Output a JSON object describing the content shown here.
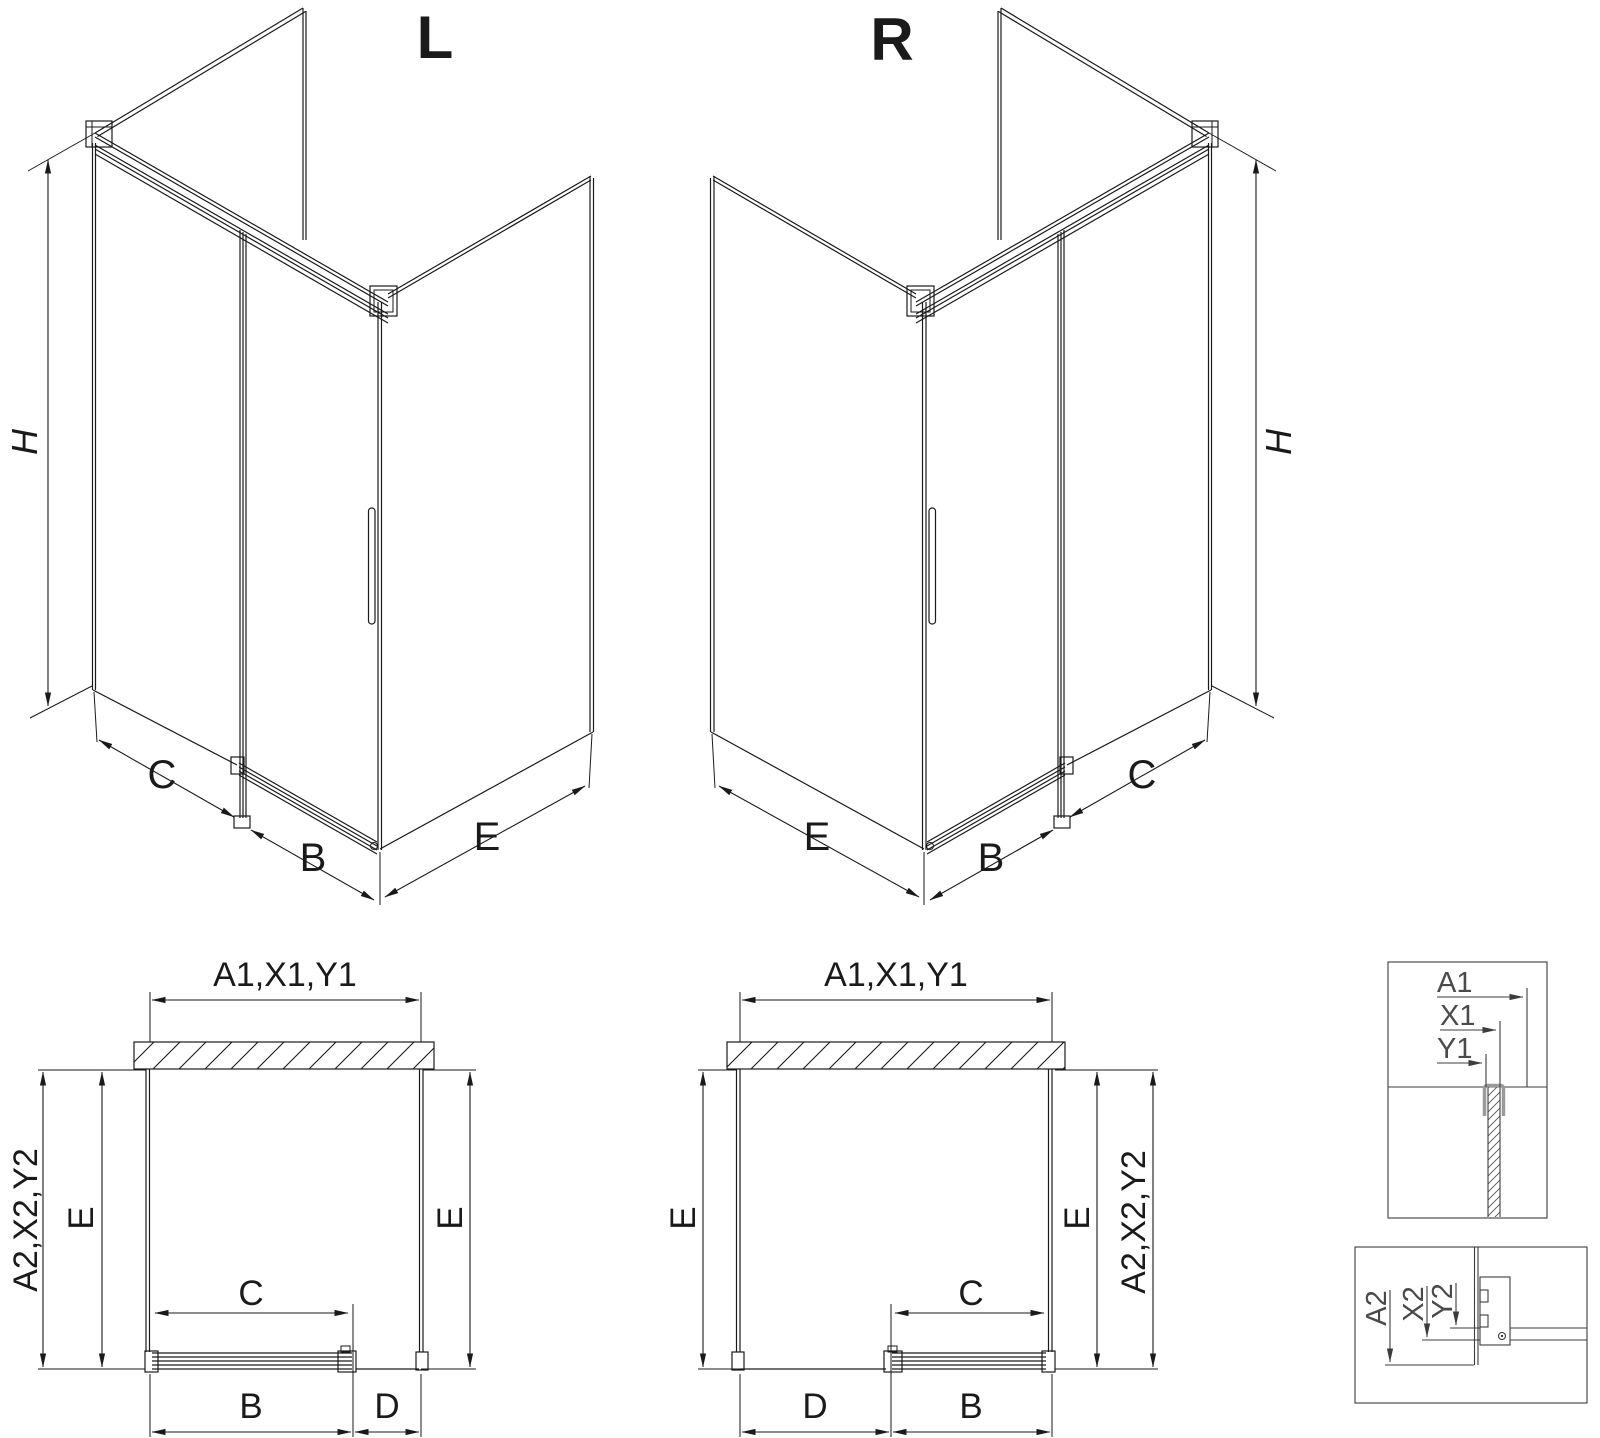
{
  "drawing": {
    "variant_left": {
      "label": "L",
      "height_dim": "H",
      "fixed_width_dim": "C",
      "door_width_dim": "B",
      "side_width_dim": "E"
    },
    "variant_right": {
      "label": "R",
      "height_dim": "H",
      "fixed_width_dim": "C",
      "door_width_dim": "B",
      "side_width_dim": "E"
    },
    "plan_left": {
      "width_dim": "A1,X1,Y1",
      "depth_dim": "A2,X2,Y2",
      "side_left_dim": "E",
      "side_right_dim": "E",
      "opening_dim": "C",
      "door_dim": "B",
      "fixed_dim": "D"
    },
    "plan_right": {
      "width_dim": "A1,X1,Y1",
      "depth_dim": "A2,X2,Y2",
      "side_left_dim": "E",
      "side_right_dim": "E",
      "opening_dim": "C",
      "door_dim": "B",
      "fixed_dim": "D"
    },
    "detail_top": {
      "dim_a": "A1",
      "dim_x": "X1",
      "dim_y": "Y1"
    },
    "detail_bottom": {
      "dim_a": "A2",
      "dim_x": "X2",
      "dim_y": "Y2"
    },
    "colors": {
      "line": "#1a1a1a",
      "detail_line": "#3c3c3c",
      "profile_gray": "#9a9a9a",
      "background": "#ffffff"
    }
  }
}
